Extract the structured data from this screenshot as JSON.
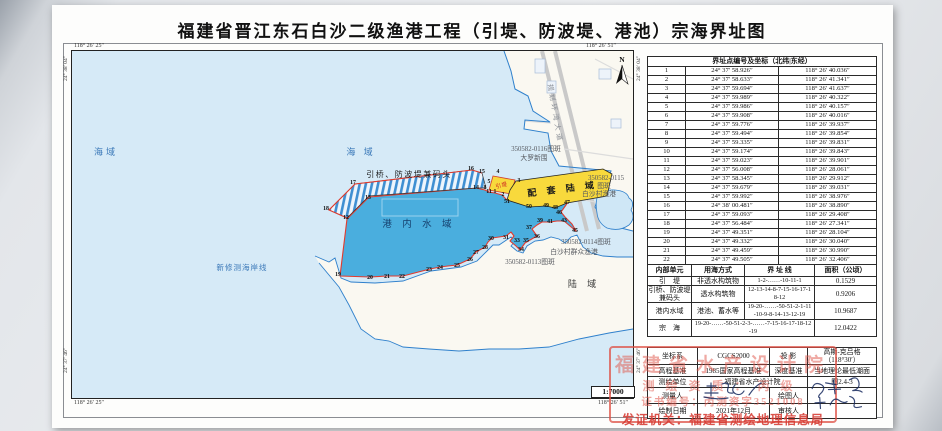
{
  "title": "福建省晋江东石白沙二级渔港工程（引堤、防波堤、港池）宗海界址图",
  "colors": {
    "sea": "#d6eaf7",
    "port_water": "#4aaede",
    "land": "#faf8f1",
    "reclaim_yellow": "#f8d93c",
    "boundary_red": "#e23b2e",
    "coast_blue": "#2f80cc",
    "stamp_red": "#de5046"
  },
  "map": {
    "scale_label": "1:7000",
    "north_label": "N",
    "corner_coords": {
      "top_left": "118° 26′ 25″",
      "top_right": "118° 26′ 51″",
      "bottom_left": "118° 26′ 25″",
      "bottom_right": "118° 26′ 51″",
      "left_top": "24° 38′ 04″",
      "left_bottom": "24° 37′ 46″",
      "right_top": "24° 38′ 04″",
      "right_bottom": "24° 37′ 46″"
    },
    "labels": [
      {
        "text": "海域",
        "x": 107,
        "y": 156,
        "cls": "lbl-sea"
      },
      {
        "text": "海  域",
        "x": 362,
        "y": 156,
        "cls": "lbl-sea"
      },
      {
        "text": "新修测海岸线",
        "x": 243,
        "y": 271,
        "cls": "lbl-coast"
      },
      {
        "text": "港 内 水 域",
        "x": 420,
        "y": 228,
        "cls": "lbl-port"
      },
      {
        "text": "陆  域",
        "x": 585,
        "y": 288,
        "cls": "lbl-land"
      },
      {
        "text": "引桥、防波堤兼码头",
        "x": 410,
        "y": 178,
        "cls": "lbl-struct"
      },
      {
        "text": "配 套 陆 域",
        "x": 564,
        "y": 193,
        "cls": "lbl-yellow",
        "rotate": -7
      },
      {
        "text": "引堤",
        "x": 503,
        "y": 188,
        "cls": "lbl-yindi",
        "rotate": -14
      },
      {
        "text": "规划环湾大道",
        "x": 554,
        "y": 115,
        "cls": "lbl-road",
        "rotate": 80
      },
      {
        "text": "350582-0116图斑",
        "x": 537,
        "y": 152,
        "cls": "lbl-patch"
      },
      {
        "text": "大罗新围",
        "x": 535,
        "y": 161,
        "cls": "lbl-patch"
      },
      {
        "text": "350582-0115",
        "x": 607,
        "y": 181,
        "cls": "lbl-patch"
      },
      {
        "text": "图斑",
        "x": 605,
        "y": 189,
        "cls": "lbl-patch"
      },
      {
        "text": "白沙村渔港",
        "x": 600,
        "y": 197,
        "cls": "lbl-patch"
      },
      {
        "text": "350582-0114图斑",
        "x": 587,
        "y": 245,
        "cls": "lbl-patch"
      },
      {
        "text": "白沙村群众渔港",
        "x": 575,
        "y": 255,
        "cls": "lbl-patch"
      },
      {
        "text": "350582-0113图斑",
        "x": 531,
        "y": 265,
        "cls": "lbl-patch"
      }
    ],
    "points": [
      {
        "n": "1",
        "x": 496,
        "y": 194
      },
      {
        "n": "2",
        "x": 504,
        "y": 197
      },
      {
        "n": "3",
        "x": 520,
        "y": 183
      },
      {
        "n": "4",
        "x": 499,
        "y": 174
      },
      {
        "n": "5",
        "x": 490,
        "y": 184
      },
      {
        "n": "8",
        "x": 486,
        "y": 190
      },
      {
        "n": "11",
        "x": 490,
        "y": 194
      },
      {
        "n": "12",
        "x": 347,
        "y": 220
      },
      {
        "n": "13",
        "x": 369,
        "y": 200
      },
      {
        "n": "14",
        "x": 477,
        "y": 190
      },
      {
        "n": "15",
        "x": 483,
        "y": 174
      },
      {
        "n": "16",
        "x": 472,
        "y": 171
      },
      {
        "n": "17",
        "x": 354,
        "y": 185
      },
      {
        "n": "18",
        "x": 327,
        "y": 211
      },
      {
        "n": "19",
        "x": 339,
        "y": 277
      },
      {
        "n": "20",
        "x": 371,
        "y": 280
      },
      {
        "n": "21",
        "x": 388,
        "y": 279
      },
      {
        "n": "22",
        "x": 403,
        "y": 279
      },
      {
        "n": "23",
        "x": 430,
        "y": 272
      },
      {
        "n": "24",
        "x": 441,
        "y": 270
      },
      {
        "n": "25",
        "x": 458,
        "y": 268
      },
      {
        "n": "26",
        "x": 471,
        "y": 262
      },
      {
        "n": "27",
        "x": 477,
        "y": 255
      },
      {
        "n": "28",
        "x": 486,
        "y": 250
      },
      {
        "n": "30",
        "x": 492,
        "y": 241
      },
      {
        "n": "31",
        "x": 507,
        "y": 240
      },
      {
        "n": "33",
        "x": 518,
        "y": 243
      },
      {
        "n": "34",
        "x": 522,
        "y": 252
      },
      {
        "n": "35",
        "x": 527,
        "y": 243
      },
      {
        "n": "36",
        "x": 538,
        "y": 239
      },
      {
        "n": "37",
        "x": 530,
        "y": 230
      },
      {
        "n": "39",
        "x": 541,
        "y": 223
      },
      {
        "n": "41",
        "x": 551,
        "y": 224
      },
      {
        "n": "43",
        "x": 565,
        "y": 223
      },
      {
        "n": "45",
        "x": 576,
        "y": 233
      },
      {
        "n": "46",
        "x": 560,
        "y": 215
      },
      {
        "n": "47",
        "x": 568,
        "y": 205
      },
      {
        "n": "48",
        "x": 556,
        "y": 210
      },
      {
        "n": "49",
        "x": 547,
        "y": 208
      },
      {
        "n": "50",
        "x": 530,
        "y": 209
      },
      {
        "n": "51",
        "x": 508,
        "y": 204
      }
    ]
  },
  "coord_table": {
    "header": "界址点编号及坐标（北纬|东经）",
    "rows": [
      [
        "1",
        "24° 37′ 58.926″",
        "118° 26′ 40.036″"
      ],
      [
        "2",
        "24° 37′ 58.633″",
        "118° 26′ 41.341″"
      ],
      [
        "3",
        "24° 37′ 59.694″",
        "118° 26′ 41.637″"
      ],
      [
        "4",
        "24° 37′ 59.989″",
        "118° 26′ 40.322″"
      ],
      [
        "5",
        "24° 37′ 59.986″",
        "118° 26′ 40.157″"
      ],
      [
        "6",
        "24° 37′ 59.908″",
        "118° 26′ 40.016″"
      ],
      [
        "7",
        "24° 37′ 59.776″",
        "118° 26′ 39.937″"
      ],
      [
        "8",
        "24° 37′ 59.494″",
        "118° 26′ 39.854″"
      ],
      [
        "9",
        "24° 37′ 59.335″",
        "118° 26′ 39.831″"
      ],
      [
        "10",
        "24° 37′ 59.174″",
        "118° 26′ 39.843″"
      ],
      [
        "11",
        "24° 37′ 59.023″",
        "118° 26′ 39.901″"
      ],
      [
        "12",
        "24° 37′ 56.008″",
        "118° 26′ 28.061″"
      ],
      [
        "13",
        "24° 37′ 58.345″",
        "118° 26′ 29.912″"
      ],
      [
        "14",
        "24° 37′ 59.679″",
        "118° 26′ 39.031″"
      ],
      [
        "15",
        "24° 37′ 59.992″",
        "118° 26′ 38.976″"
      ],
      [
        "16",
        "24° 38′ 00.481″",
        "118° 26′ 38.890″"
      ],
      [
        "17",
        "24° 37′ 59.093″",
        "118° 26′ 29.408″"
      ],
      [
        "18",
        "24° 37′ 56.484″",
        "118° 26′ 27.341″"
      ],
      [
        "19",
        "24° 37′ 49.351″",
        "118° 26′ 28.104″"
      ],
      [
        "20",
        "24° 37′ 49.332″",
        "118° 26′ 30.040″"
      ],
      [
        "21",
        "24° 37′ 49.459″",
        "118° 26′ 30.990″"
      ],
      [
        "22",
        "24° 37′ 49.505″",
        "118° 26′ 32.406″"
      ],
      [
        "23",
        "24° 37′ 50.062″",
        "118° 26′ 34.543″"
      ]
    ],
    "footer": "剩余界址点编号及坐标（北纬|东经），见附页"
  },
  "area_table": {
    "headers": [
      "内部单元",
      "用海方式",
      "界 址 线",
      "面积（公顷）"
    ],
    "rows": [
      {
        "cells": [
          {
            "t": "引　堤"
          },
          {
            "t": "非透水构筑物"
          },
          {
            "t": "1-2-……-10-11-1",
            "cls": "line"
          },
          {
            "t": "0.1529"
          }
        ]
      },
      {
        "cells": [
          {
            "t": "引桥、防波堤兼码头"
          },
          {
            "t": "透水构筑物"
          },
          {
            "t": "12-13-14-8-7-15-16-17-18-12",
            "cls": "line"
          },
          {
            "t": "0.9206"
          }
        ]
      },
      {
        "cells": [
          {
            "t": "港内水域"
          },
          {
            "t": "港池、蓄水等"
          },
          {
            "t": "19-20-……-50-51-2-1-11-10-9-8-14-13-12-19",
            "cls": "line"
          },
          {
            "t": "10.9687"
          }
        ]
      },
      {
        "cells": [
          {
            "t": "宗　海"
          },
          {
            "t": "19-20-……-50-51-2-3-……-7-15-16-17-18-12-19",
            "span": 2,
            "cls": "line"
          },
          {
            "t": "12.0422"
          }
        ]
      }
    ]
  },
  "meta_table": {
    "rows": [
      {
        "h": 12,
        "cells": [
          {
            "t": "坐标系"
          },
          {
            "t": "CGCS2000"
          },
          {
            "t": "投 影"
          },
          {
            "t": "高斯-克吕格（118°30′）"
          }
        ]
      },
      {
        "h": 12,
        "cells": [
          {
            "t": "高程基准"
          },
          {
            "t": "1985国家高程基准"
          },
          {
            "t": "深度基准"
          },
          {
            "t": "当地理论最低潮面"
          }
        ]
      },
      {
        "h": 11,
        "cells": [
          {
            "t": "测绘单位"
          },
          {
            "t": "福建省水产设计院",
            "span": 2
          },
          {
            "t": "图2.4-3"
          }
        ]
      },
      {
        "h": 16,
        "cells": [
          {
            "t": "测量人"
          },
          {
            "t": ""
          },
          {
            "t": "绘图人"
          },
          {
            "t": ""
          }
        ]
      },
      {
        "h": 15,
        "cells": [
          {
            "t": "绘制日期"
          },
          {
            "t": "2021年12月"
          },
          {
            "t": "审核人"
          },
          {
            "t": ""
          }
        ]
      }
    ]
  },
  "stamp": {
    "line1": "福建省水产设计院",
    "line2": "测绘资质：丙级",
    "line3": "证书编号：丙测资字3521008",
    "line4": "发证机关：福建省测绘地理信息局"
  }
}
